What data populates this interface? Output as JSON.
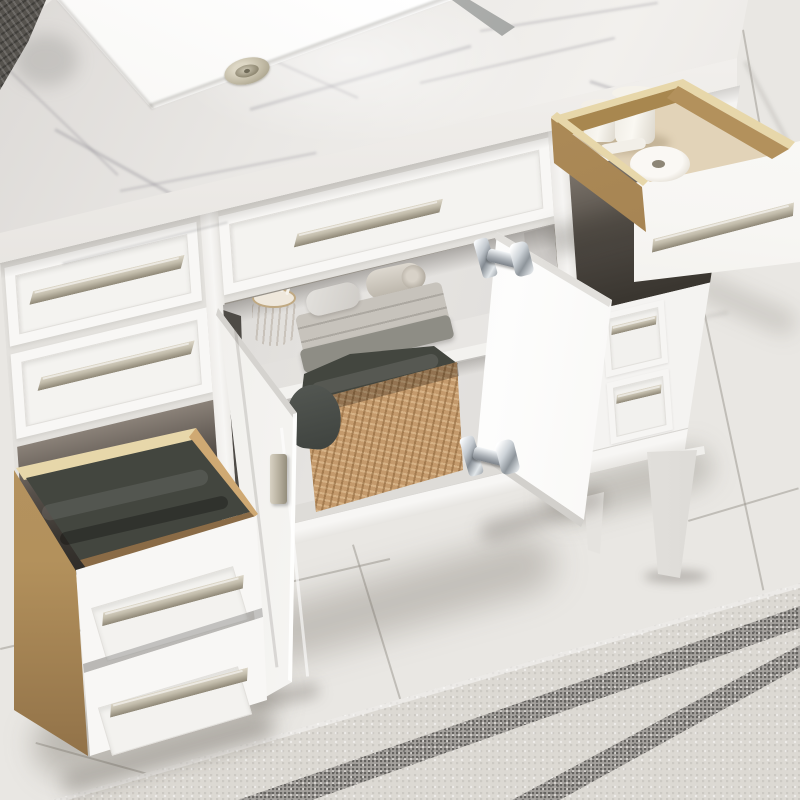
{
  "scene": {
    "type": "product-photo",
    "setting": "bathroom",
    "description": "White shaker-style bathroom vanity with Carrara marble top, undermount sink, open oak drawers and open cabinet doors, photographed from above on a marble tile floor with granite mosaic border strips",
    "objects": {
      "countertop": "Carrara marble countertop with eased edge",
      "sink": "White rectangular undermount sink",
      "drain": "Brushed nickel pop-up drain",
      "faucet": "Faucet base cropped at top edge",
      "corner_towel": "Dark knit towel on counter corner",
      "left_drawer_1": "Closed shaker drawer with bar pull",
      "left_drawer_2": "Closed shaker drawer with bar pull",
      "center_drawer": "Wide closed shaker drawer under sink",
      "open_top_drawer": "Pulled-out oak drawer with toiletries",
      "jar_small": "Small white ceramic jar",
      "jar_large": "Large white ceramic jar with lid",
      "tube": "White tube",
      "paper_roll": "White paper roll",
      "open_bottom_drawer": "Pulled-out deep oak drawer with double white front",
      "drawer_towel": "Folded charcoal towel inside drawer",
      "left_door": "Open cabinet door with nickel finger pull",
      "right_door": "Open cabinet door with chrome hinges",
      "hinge_top": "Chrome soft-close hinge, upper",
      "hinge_bottom": "Chrome soft-close hinge, lower",
      "shelf": "Adjustable interior shelf",
      "shelf_towel_stack": "Folded light gray towels",
      "rolled_towel": "Rolled beige towel",
      "soap": "Gray soap bar",
      "swab_cup": "Wooden cup with cotton swabs",
      "basket": "Woven rattan basket with charcoal towels",
      "basket_drape": "Towel draped over basket corner",
      "right_bank_drawer_1": "Small side drawer with pull",
      "right_bank_drawer_2": "Small side drawer with pull",
      "front_leg": "Tapered white vanity leg",
      "rear_leg": "Rear tapered leg in shadow",
      "stretcher": "Side stretcher rail",
      "floor": "White marble-look tile floor",
      "border_strips": "Two gray granite mosaic border strips",
      "pull": "Brushed nickel bar pull"
    },
    "counts": {
      "open_drawers": 2,
      "open_doors": 2,
      "closed_drawer_fronts": 5,
      "visible_pulls": 9,
      "visible_hinges": 2,
      "visible_legs": 2
    }
  },
  "palette": {
    "floor-base": "#e9e7e3",
    "floor-border": "#dcd9d3",
    "strip-gray": "#a4a19d",
    "marble-base": "#eae8e5",
    "marble-edge": "#cfccc7",
    "sink-white": "#ffffff",
    "cabinet-white": "#f8f7f5",
    "panel-inset": "#f4f3f0",
    "gap": "#e3e1dd",
    "nickel": "#c2bcab",
    "nickel-dark": "#8e8776",
    "oak": "#b3915c",
    "birch": "#e7d7aa",
    "drawer-interior": "#cbbb9e",
    "towel-charcoal": "#43463f",
    "towel-gray": "#c7c3bc",
    "towel-green": "#8e8d85",
    "basket-tan": "#c49a6c",
    "chrome": "#c3c9cf",
    "interior-wall": "#e6e4e1"
  }
}
